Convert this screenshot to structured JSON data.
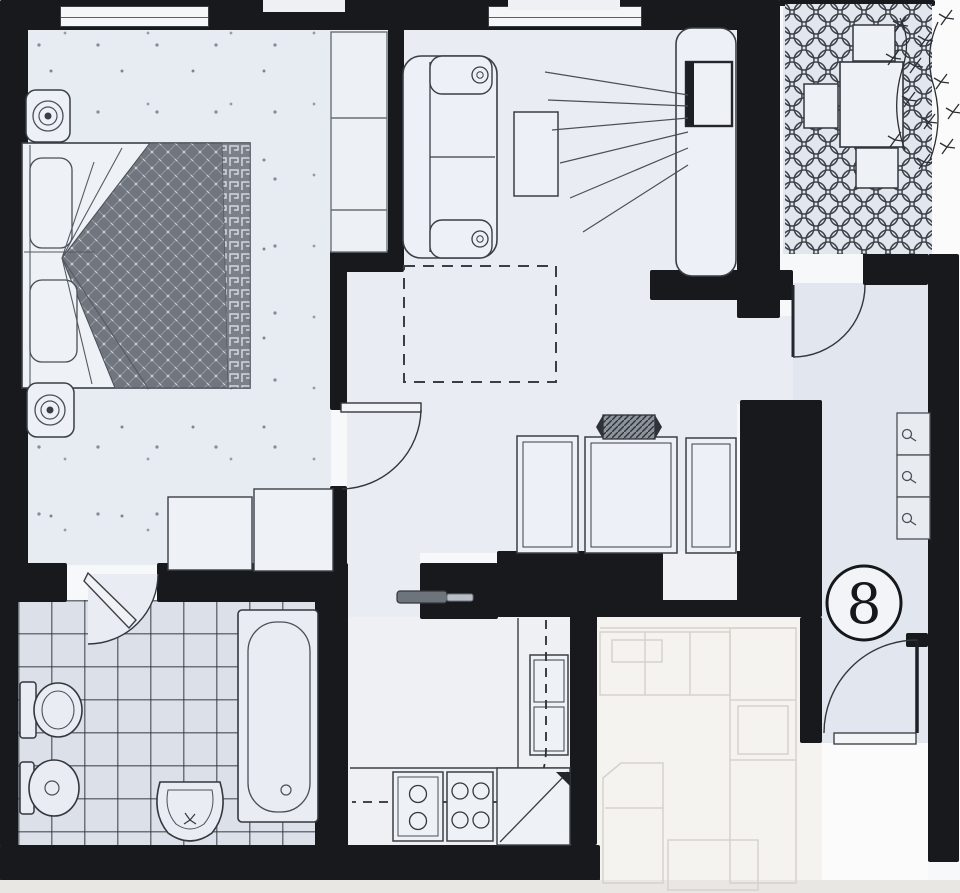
{
  "plan": {
    "unit_number": "8",
    "colors": {
      "wall": "#17191d",
      "floor": "#e9edf3",
      "bath_tile_line": "#2b3038",
      "quilt": "#70757e",
      "ghost_line": "#d6d1ca",
      "paper": "#f7f8f9"
    },
    "rooms": [
      "bedroom",
      "living-room",
      "balcony",
      "entry-hall",
      "bathroom",
      "kitchen",
      "adjacent-unit-ghost"
    ],
    "furniture": [
      "double-bed",
      "pillows",
      "patterned-quilt",
      "nightstand-lamps",
      "closet",
      "dresser",
      "sofa",
      "coffee-table",
      "tv-cabinet",
      "tv",
      "tv-viewing-lines",
      "dashed-dining-area",
      "bench-seats",
      "hatched-radiator-bar",
      "balcony-table",
      "balcony-chairs",
      "potted-plant",
      "hall-cabinets",
      "toilet",
      "bidet",
      "wash-basin",
      "bathtub",
      "kitchen-sink",
      "stove-burners",
      "corner-cabinet",
      "sliding-door",
      "door-swing-arcs"
    ]
  }
}
